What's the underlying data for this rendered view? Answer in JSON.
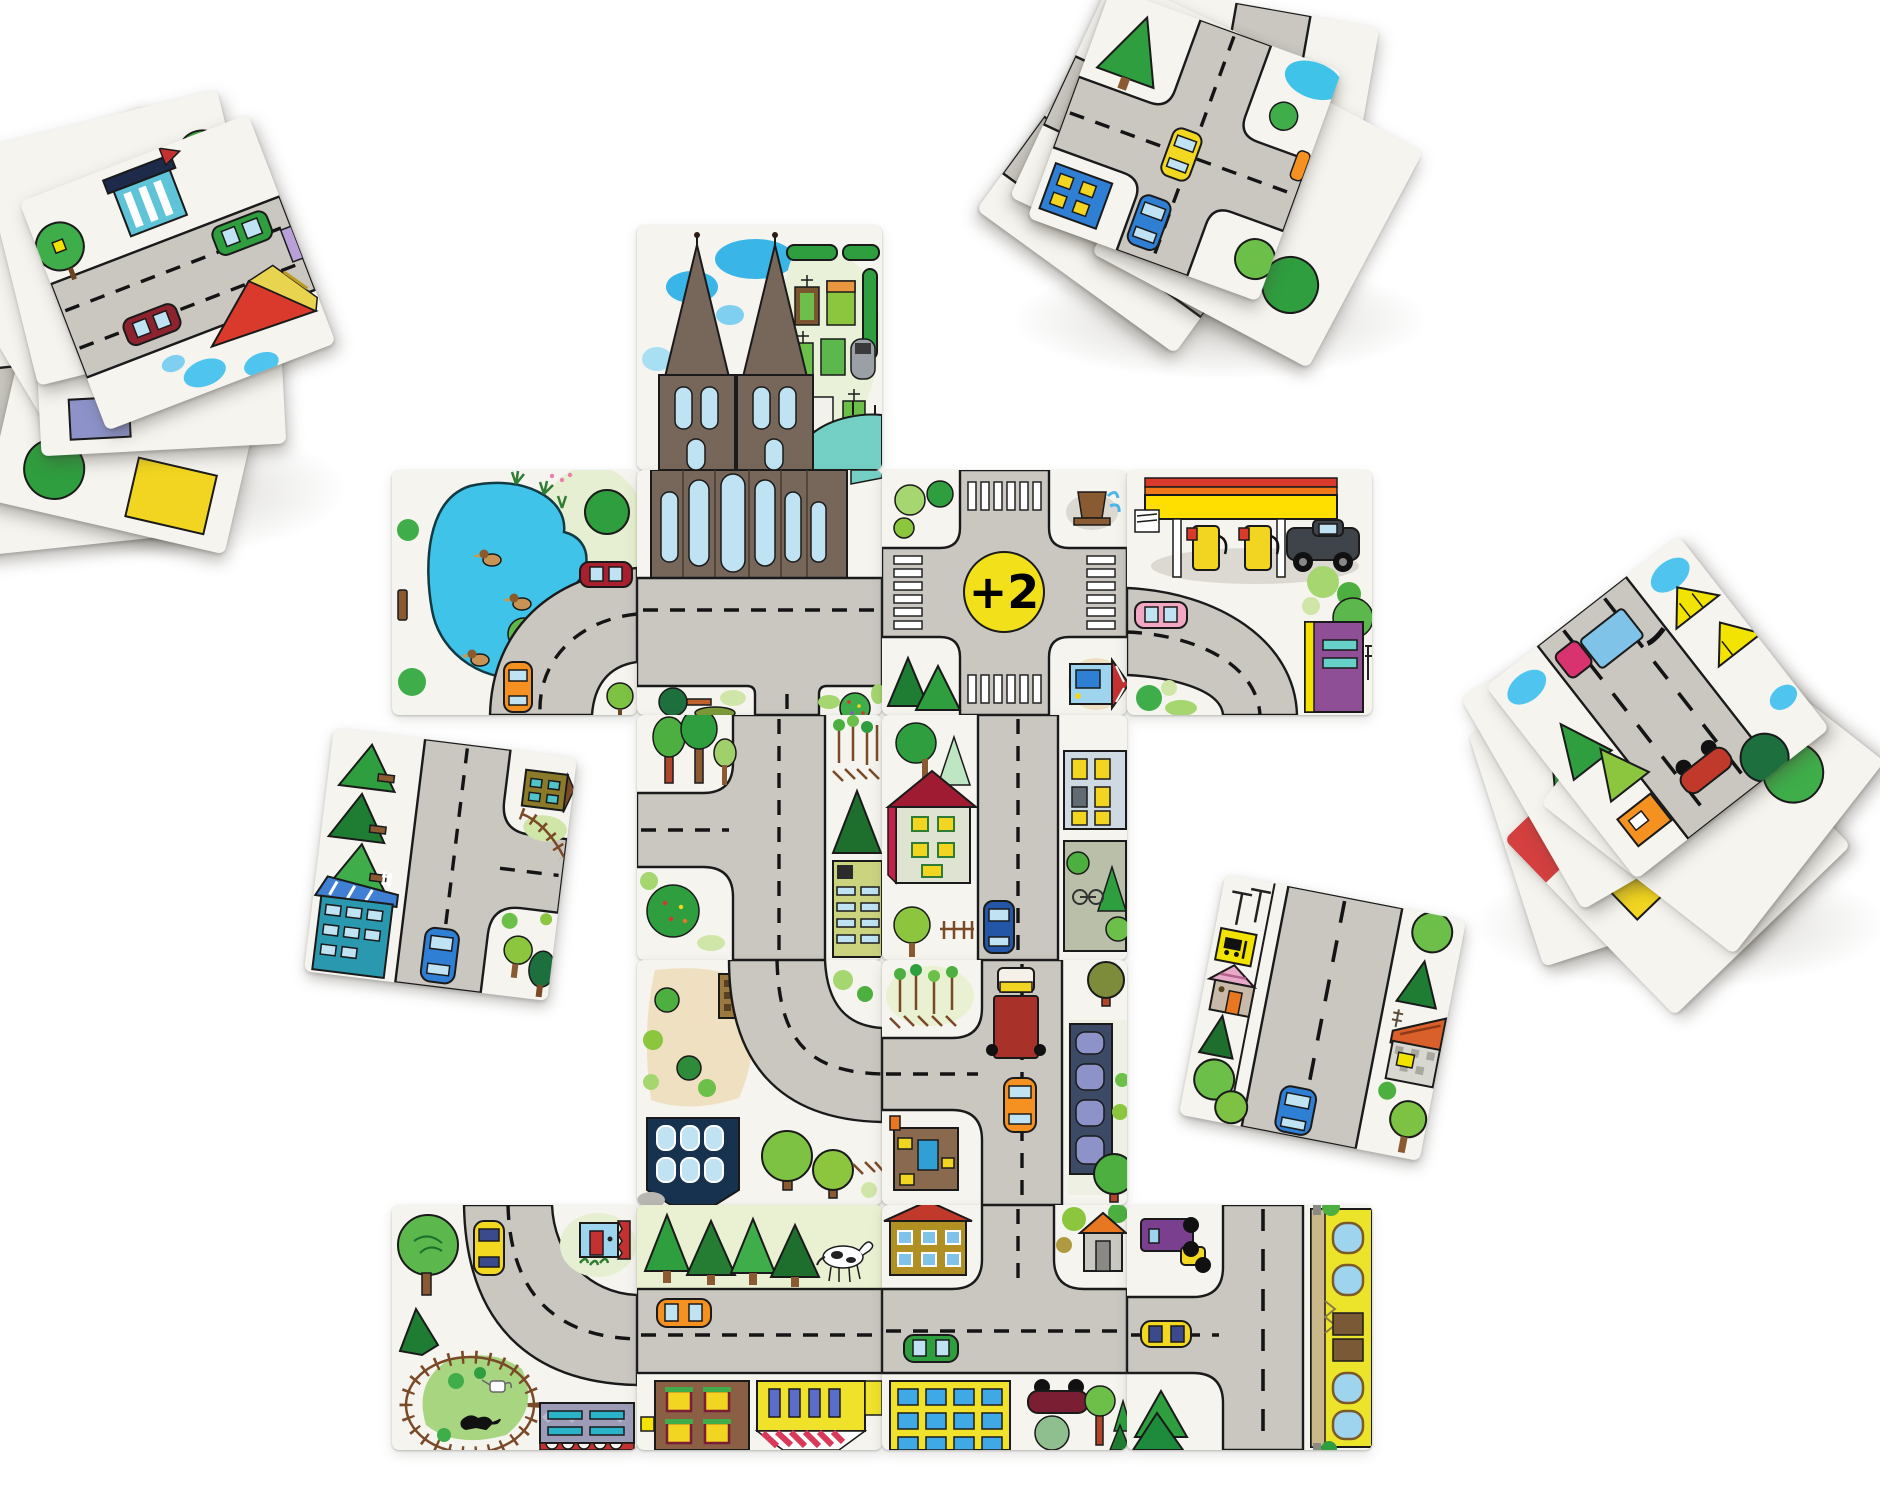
{
  "scene": {
    "title": "Road-building tile game — overhead photo",
    "background": "#ffffff"
  },
  "bonus_token": {
    "label": "+2",
    "bg": "#f2e11a",
    "fg": "#111111"
  },
  "palette": {
    "tile": "#f5f4ef",
    "road": "#cac7c1",
    "road_line": "#141414",
    "pond_blue": "#3fc3e8",
    "canopy_yellow": "#ffd900",
    "accent_red": "#c43131",
    "cathedral_brown": "#77665a",
    "nave_teal": "#74cfc4",
    "grass_light": "#e7efd2"
  },
  "board": {
    "tile_px": 245,
    "origin_px": {
      "x": 392,
      "y": 225
    },
    "rows": 5,
    "cols": 4,
    "placed_tiles": [
      {
        "id": "cathedral-spires",
        "row": 0,
        "col": 1,
        "features": [
          "cathedral spires",
          "blue clouds",
          "graveyard hedges",
          "gravestones",
          "teal nave roof"
        ]
      },
      {
        "id": "duck-pond",
        "row": 1,
        "col": 0,
        "features": [
          "pond",
          "three ducks",
          "bench",
          "curved road right-to-bottom",
          "dark red car",
          "orange car",
          "berry bush"
        ]
      },
      {
        "id": "cathedral-facade",
        "row": 1,
        "col": 1,
        "features": [
          "cathedral facade",
          "arched windows",
          "road with branch down",
          "dark tree",
          "dotted bush"
        ]
      },
      {
        "id": "crossroads-bonus",
        "row": 1,
        "col": 2,
        "features": [
          "four-way crossing",
          "zebra crosswalks",
          "+2 token",
          "fountain",
          "bushes",
          "two firs",
          "blue house with red roof"
        ]
      },
      {
        "id": "gas-station",
        "row": 1,
        "col": 3,
        "features": [
          "yellow canopy",
          "two fuel pumps",
          "dark pickup truck",
          "curved road left-to-bottom",
          "pink car",
          "purple kiosk",
          "round tree"
        ]
      },
      {
        "id": "t-junction-west",
        "row": 2,
        "col": 1,
        "features": [
          "vertical road",
          "branch to left",
          "three trees",
          "berry bush",
          "saplings and fence",
          "fir",
          "green apartment block"
        ]
      },
      {
        "id": "street-red-roof",
        "row": 2,
        "col": 2,
        "features": [
          "vertical road",
          "red-roofed house",
          "apartment with yellow windows",
          "courtyard wall",
          "bicycle",
          "blue car"
        ]
      },
      {
        "id": "bend-north-east",
        "row": 3,
        "col": 1,
        "features": [
          "curved road top-to-right",
          "sand park",
          "small brown house",
          "navy apartment house",
          "round trees",
          "fence"
        ]
      },
      {
        "id": "t-junction-west-2",
        "row": 3,
        "col": 2,
        "features": [
          "vertical road",
          "branch to left",
          "red truck",
          "orange car",
          "dark arched building",
          "brown house with blue door",
          "trees"
        ]
      },
      {
        "id": "bend-rail-meadow",
        "row": 4,
        "col": 0,
        "features": [
          "curved road top-to-right",
          "yellow car",
          "blue kiosk with red awning",
          "round tree",
          "spiky bush",
          "railway loop",
          "meadow",
          "black cat",
          "watering can",
          "patterned building with red base"
        ]
      },
      {
        "id": "avenue-horse",
        "row": 4,
        "col": 1,
        "features": [
          "horizontal road",
          "orange taxi",
          "four firs",
          "white horse",
          "brown house with window boxes",
          "yellow shop with striped awning"
        ]
      },
      {
        "id": "junction-village",
        "row": 4,
        "col": 2,
        "features": [
          "horizontal road",
          "road from top",
          "green car",
          "mustard house with red roof",
          "grey shed with orange roof",
          "yellow building with blue windows",
          "overturned car",
          "trees"
        ]
      },
      {
        "id": "t-junction-yellow-row",
        "row": 4,
        "col": 3,
        "features": [
          "vertical road",
          "branch from left",
          "purple truck",
          "yellow car",
          "two firs",
          "long yellow house with arched windows"
        ]
      }
    ]
  },
  "loose_tiles": [
    {
      "id": "fir-lane",
      "rotation_deg": 7,
      "features": [
        "vertical road",
        "branch to right",
        "three firs",
        "round tree",
        "teal house with blue roof",
        "olive house",
        "rail curve",
        "blue car",
        "trees"
      ]
    },
    {
      "id": "bus-stop-street",
      "rotation_deg": 11,
      "features": [
        "wide vertical road",
        "bus-stop sign",
        "sign posts",
        "pink-roof house",
        "checker house with orange roof",
        "firs",
        "round trees",
        "blue car"
      ]
    }
  ],
  "stacks": [
    {
      "id": "top-left-stack",
      "tile_count": 8,
      "top_tile_features": [
        "wide road",
        "green van",
        "dark red car",
        "tree with birdhouse",
        "teal striped building with flag",
        "red roof house",
        "clouds"
      ]
    },
    {
      "id": "top-right-stack",
      "tile_count": 6,
      "top_tile_features": [
        "crossroads",
        "yellow car",
        "blue car",
        "fir",
        "blue house with yellow windows",
        "round tree",
        "pond corner"
      ]
    },
    {
      "id": "right-stack",
      "tile_count": 7,
      "top_tile_features": [
        "road with pink truck",
        "clouds",
        "two yellow tents",
        "firs",
        "overturned red car",
        "orange kiosk",
        "dark tree"
      ]
    }
  ]
}
